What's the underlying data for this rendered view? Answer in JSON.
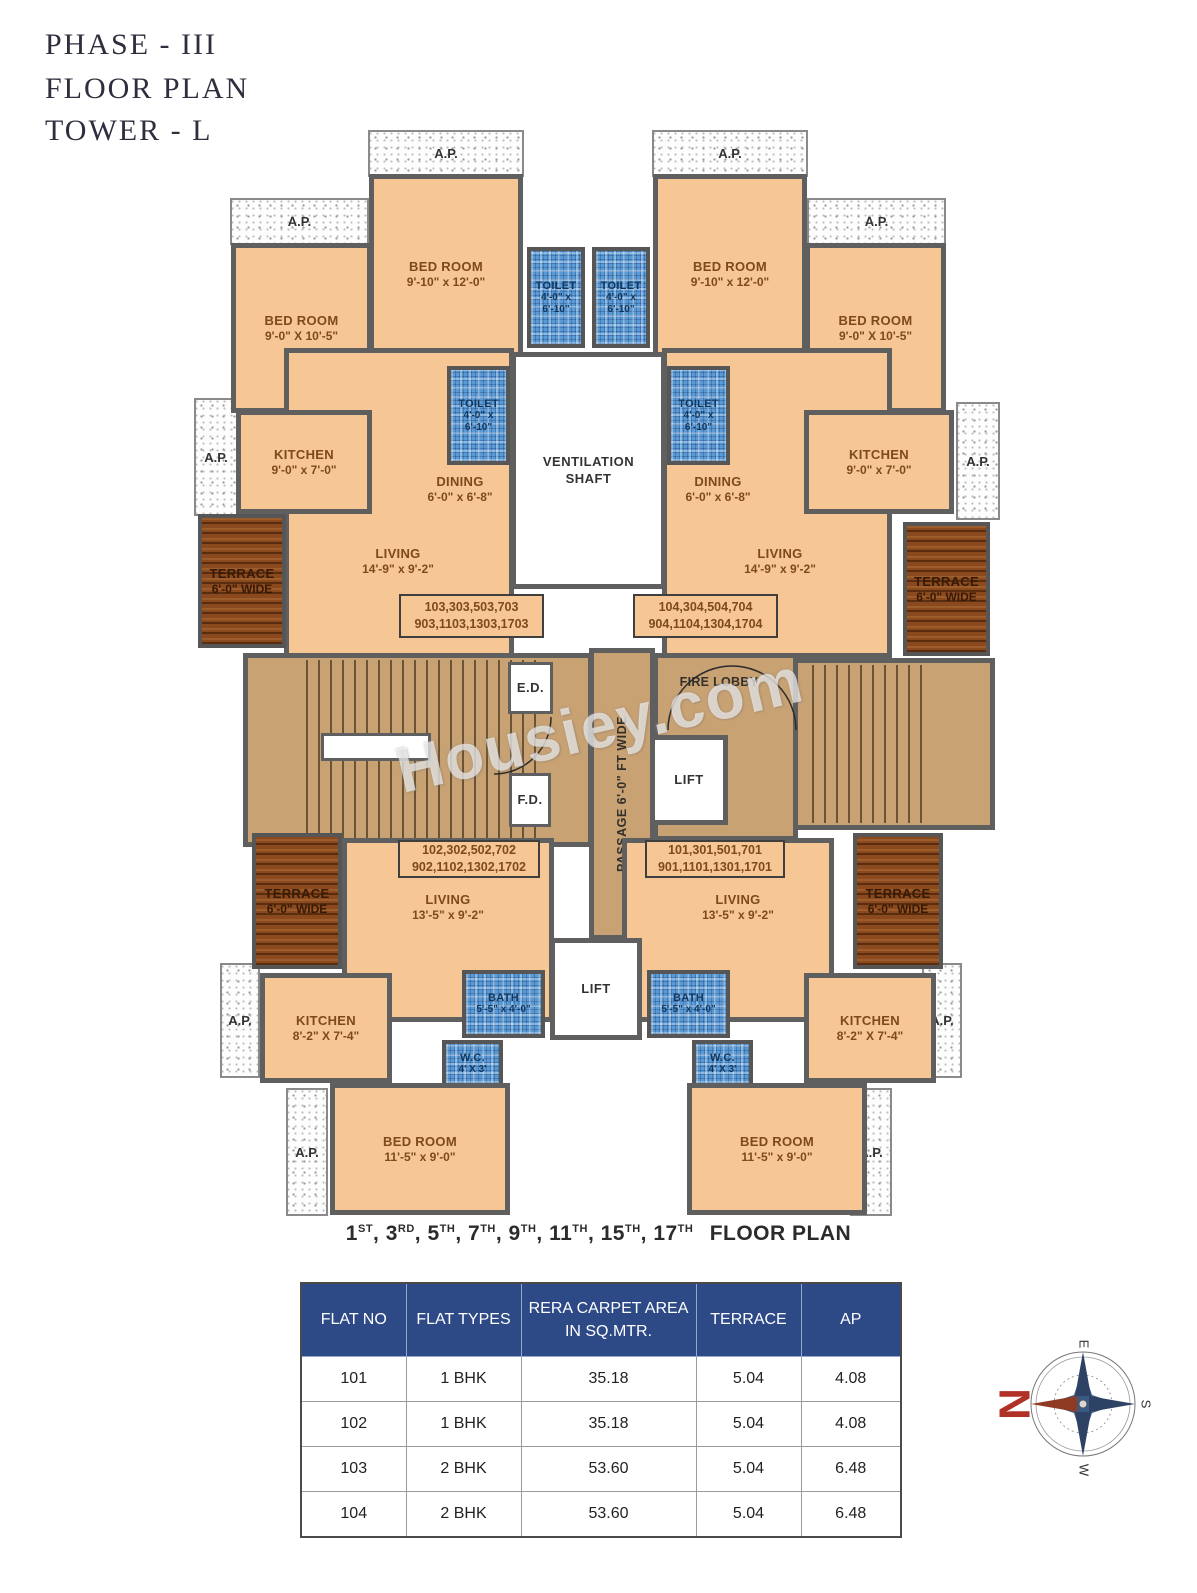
{
  "title": {
    "line1": "PHASE - III",
    "line2": "FLOOR PLAN",
    "line3": "TOWER  - L"
  },
  "watermark": "Housiey.com",
  "colors": {
    "room_fill": "#f6c795",
    "wall_gray": "#5f5f5f",
    "wet_blue": "#5b9bd5",
    "terrace_wood": "#8a4a1e",
    "corridor_tan": "#c9a273",
    "table_header_blue": "#2d4a87",
    "compass_north_red": "#b03226"
  },
  "plan": {
    "ap": "A.P.",
    "rooms": {
      "bedroom_small": {
        "name": "BED ROOM",
        "dims": "9'-0\" X 10'-5\""
      },
      "bedroom_large": {
        "name": "BED ROOM",
        "dims": "9'-10\" x 12'-0\""
      },
      "toilet": {
        "name": "TOILET",
        "dims": "4'-0\" x 6'-10\""
      },
      "kitchen_mid": {
        "name": "KITCHEN",
        "dims": "9'-0\" x 7'-0\""
      },
      "dining": {
        "name": "DINING",
        "dims": "6'-0\" x 6'-8\""
      },
      "living_mid": {
        "name": "LIVING",
        "dims": "14'-9\" x 9'-2\""
      },
      "living_low": {
        "name": "LIVING",
        "dims": "13'-5\" x 9'-2\""
      },
      "terrace": {
        "name": "TERRACE",
        "dims": "6'-0\" WIDE"
      },
      "ventilation": {
        "line1": "VENTILATION",
        "line2": "SHAFT"
      },
      "bath": {
        "name": "BATH",
        "dims": "5'-5\" x 4'-0\""
      },
      "wc": {
        "name": "W.C.",
        "dims": "4' X 3'"
      },
      "kitchen_low": {
        "name": "KITCHEN",
        "dims": "8'-2\" X 7'-4\""
      },
      "bedroom_low": {
        "name": "BED ROOM",
        "dims": "11'-5\" x 9'-0\""
      },
      "fire_lobby": "FIRE LOBBY",
      "lift": "LIFT",
      "ed": "E.D.",
      "fd": "F.D.",
      "passage": "PASSAGE 6'-0\" FT WIDE"
    },
    "units": {
      "u103": {
        "l1": "103,303,503,703",
        "l2": "903,1103,1303,1703"
      },
      "u104": {
        "l1": "104,304,504,704",
        "l2": "904,1104,1304,1704"
      },
      "u102": {
        "l1": "102,302,502,702",
        "l2": "902,1102,1302,1702"
      },
      "u101": {
        "l1": "101,301,501,701",
        "l2": "901,1101,1301,1701"
      }
    }
  },
  "caption": {
    "items": [
      {
        "num": "1",
        "sup": "ST",
        "sep": ", "
      },
      {
        "num": "3",
        "sup": "RD",
        "sep": ", "
      },
      {
        "num": "5",
        "sup": "TH",
        "sep": ", "
      },
      {
        "num": "7",
        "sup": "TH",
        "sep": ", "
      },
      {
        "num": "9",
        "sup": "TH",
        "sep": ", "
      },
      {
        "num": "11",
        "sup": "TH",
        "sep": ", "
      },
      {
        "num": "15",
        "sup": "TH",
        "sep": ", "
      },
      {
        "num": "17",
        "sup": "TH",
        "sep": ""
      }
    ],
    "suffix": "FLOOR PLAN"
  },
  "table": {
    "headers": [
      "FLAT NO",
      "FLAT TYPES",
      "RERA CARPET AREA IN SQ.MTR.",
      "TERRACE",
      "AP"
    ],
    "rows": [
      [
        "101",
        "1 BHK",
        "35.18",
        "5.04",
        "4.08"
      ],
      [
        "102",
        "1 BHK",
        "35.18",
        "5.04",
        "4.08"
      ],
      [
        "103",
        "2 BHK",
        "53.60",
        "5.04",
        "6.48"
      ],
      [
        "104",
        "2 BHK",
        "53.60",
        "5.04",
        "6.48"
      ]
    ]
  },
  "compass": {
    "n": "N",
    "e": "E",
    "s": "S",
    "w": "W"
  }
}
